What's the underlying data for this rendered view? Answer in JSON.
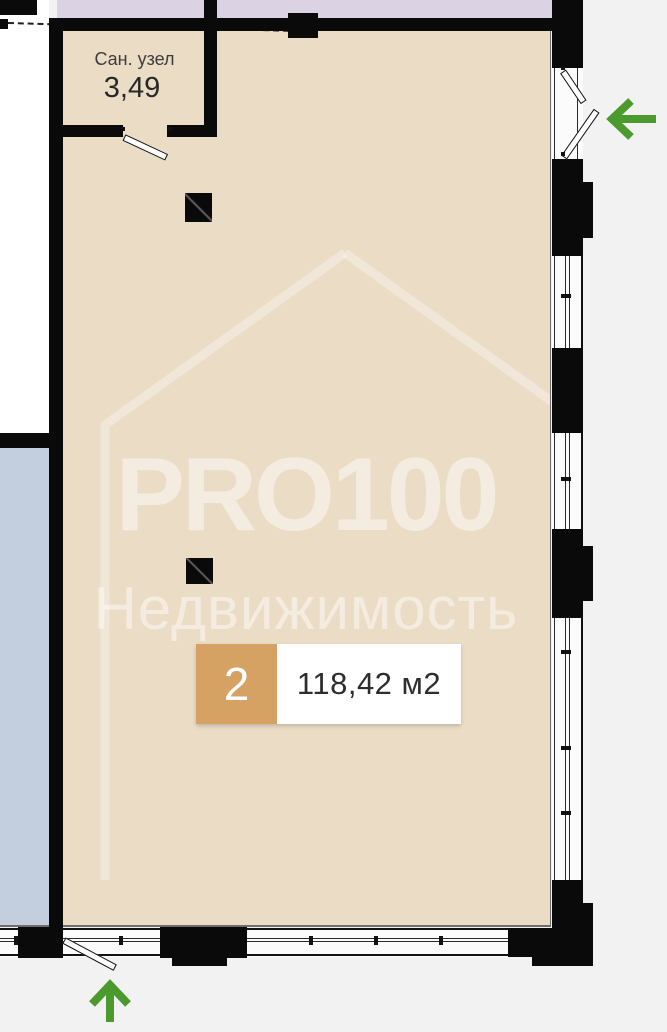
{
  "plan": {
    "type": "floor-plan",
    "rooms": [
      {
        "name": "Сан. узел",
        "area": "3,49"
      }
    ],
    "unit": {
      "number": "2",
      "area_label": "118,42 м2"
    },
    "watermark": {
      "brand": "PRO100",
      "subtitle": "Недвижимость"
    },
    "icons": {
      "entrance_right": "entrance-arrow-left-icon",
      "entrance_bottom": "entrance-arrow-up-icon"
    },
    "colors": {
      "floor": "#EBDCC6",
      "neighbor_top": "#DBD2E3",
      "neighbor_left": "#C3CEDE",
      "outside": "#F2F2F2",
      "walls": "#0A0A0A",
      "badge": "#D6A263",
      "arrow_green": "#4A9A2E"
    }
  }
}
